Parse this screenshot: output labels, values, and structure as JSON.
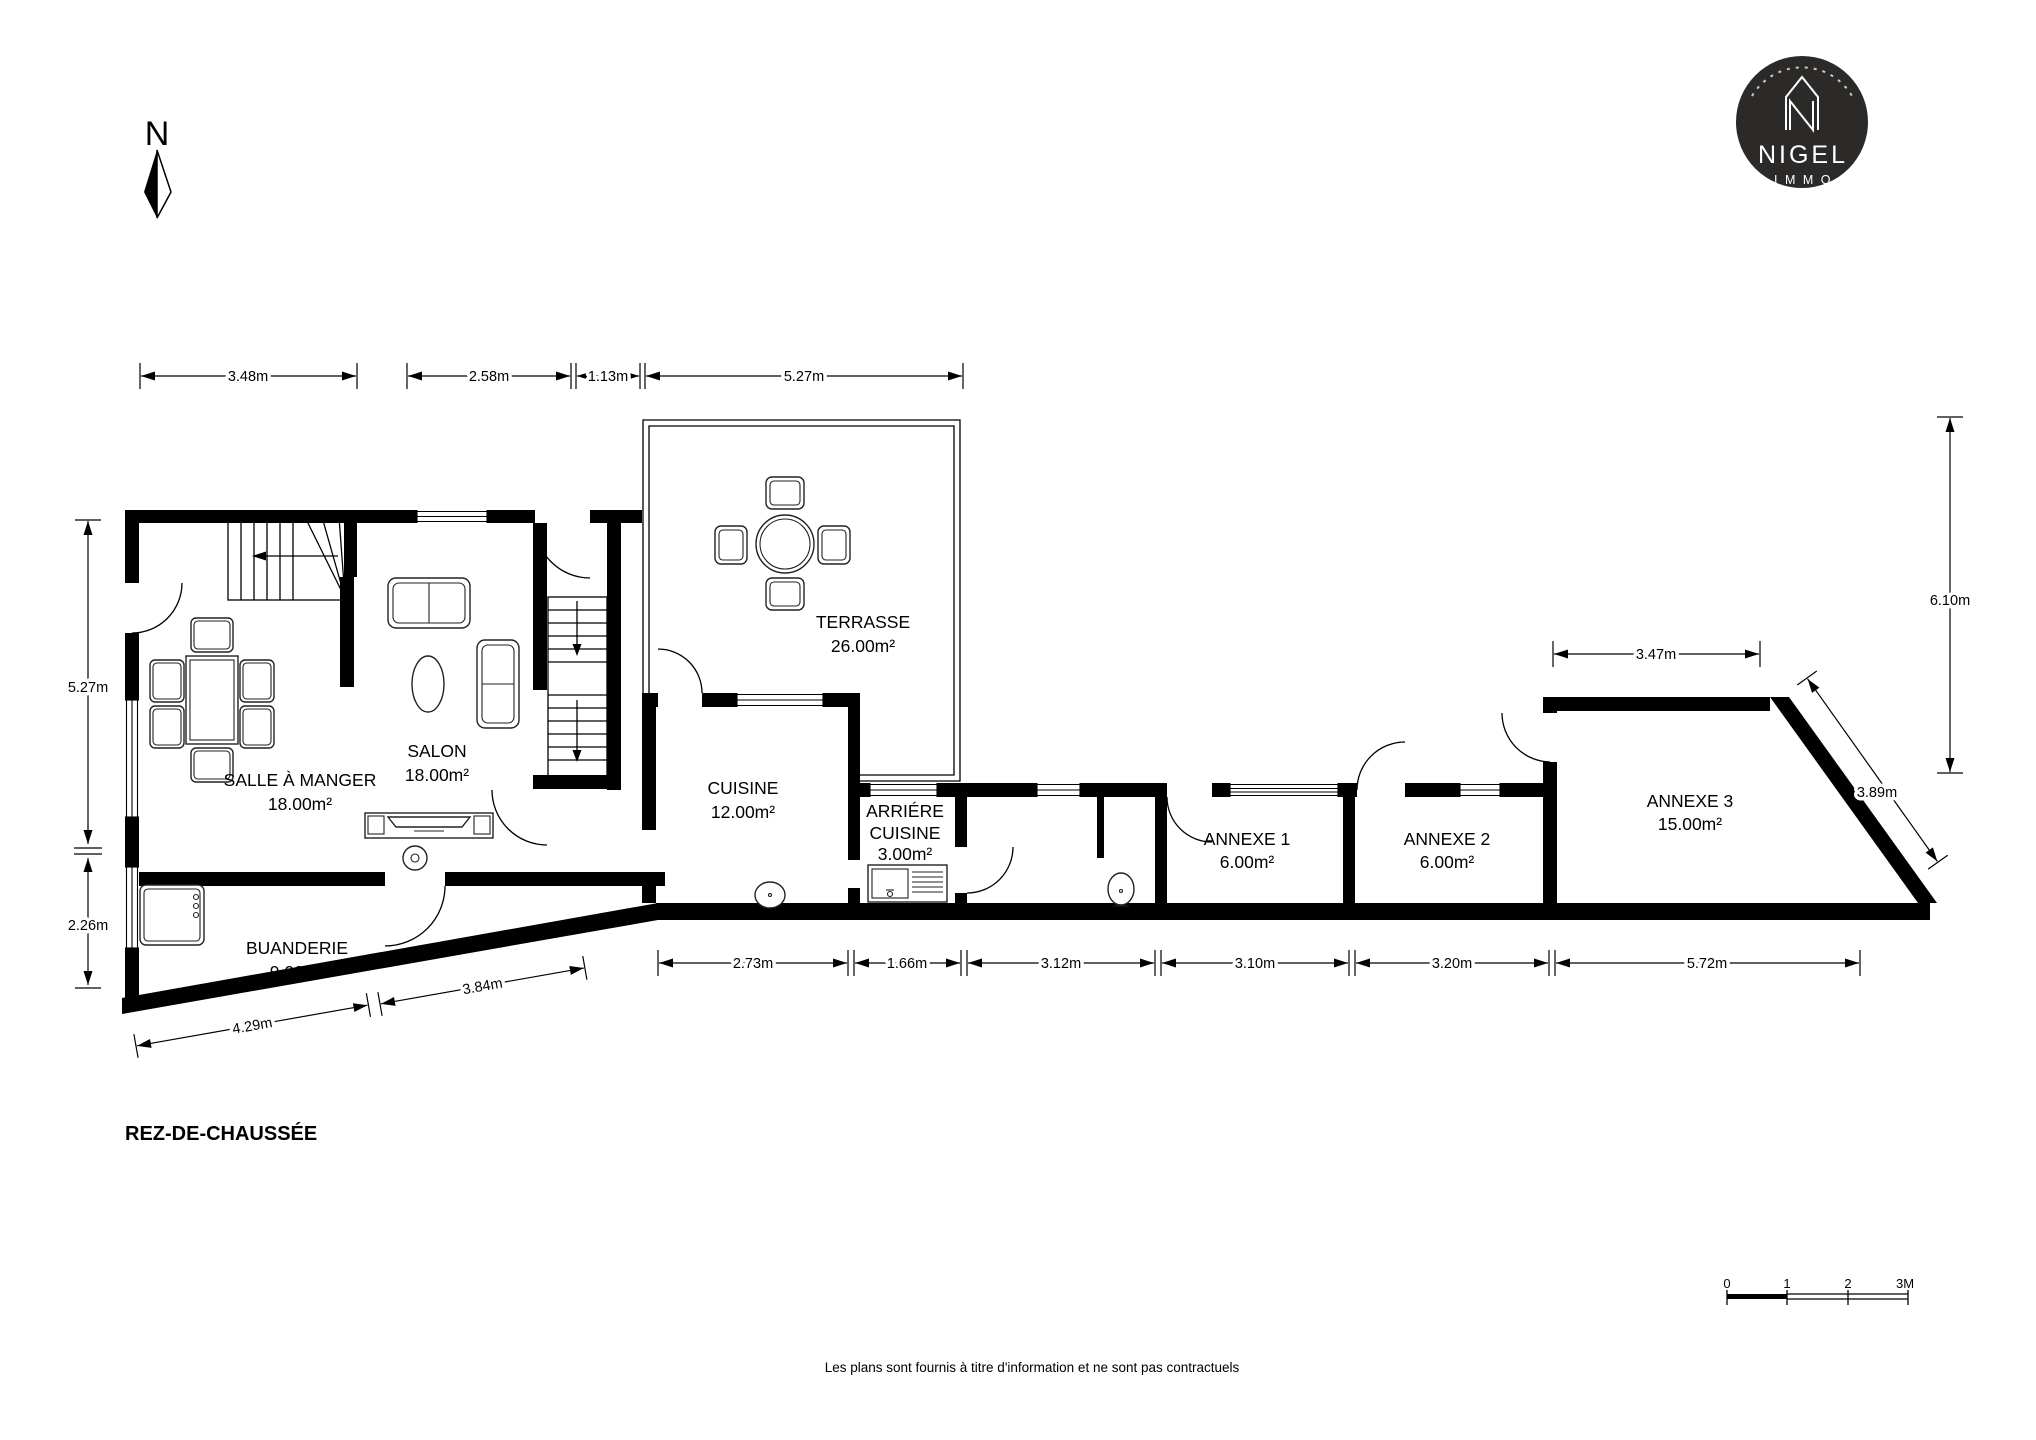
{
  "header": {
    "north_label": "N"
  },
  "logo": {
    "brand": "NIGEL",
    "sub": "IMMO"
  },
  "plan": {
    "title": "REZ-DE-CHAUSSÉE",
    "disclaimer": "Les plans sont fournis à titre d'information et ne sont pas contractuels"
  },
  "rooms": {
    "salle_a_manger": {
      "name": "SALLE À MANGER",
      "area": "18.00m²"
    },
    "salon": {
      "name": "SALON",
      "area": "18.00m²"
    },
    "buanderie": {
      "name": "BUANDERIE",
      "area": "9.00m²"
    },
    "terrasse": {
      "name": "TERRASSE",
      "area": "26.00m²"
    },
    "cuisine": {
      "name": "CUISINE",
      "area": "12.00m²"
    },
    "arriere_cuisine": {
      "name_line1": "ARRIÉRE",
      "name_line2": "CUISINE",
      "area": "3.00m²"
    },
    "annexe1": {
      "name": "ANNEXE 1",
      "area": "6.00m²"
    },
    "annexe2": {
      "name": "ANNEXE 2",
      "area": "6.00m²"
    },
    "annexe3": {
      "name": "ANNEXE 3",
      "area": "15.00m²"
    }
  },
  "dimensions": {
    "top": [
      "3.48m",
      "2.58m",
      "1.13m",
      "5.27m"
    ],
    "left": [
      "5.27m",
      "2.26m"
    ],
    "right": [
      "6.10m",
      "3.47m",
      "3.89m"
    ],
    "bottom": [
      "2.73m",
      "1.66m",
      "3.12m",
      "3.10m",
      "3.20m",
      "5.72m"
    ],
    "slanted": [
      "4.29m",
      "3.84m"
    ]
  },
  "scale_bar": {
    "labels": [
      "0",
      "1",
      "2",
      "3M"
    ]
  }
}
